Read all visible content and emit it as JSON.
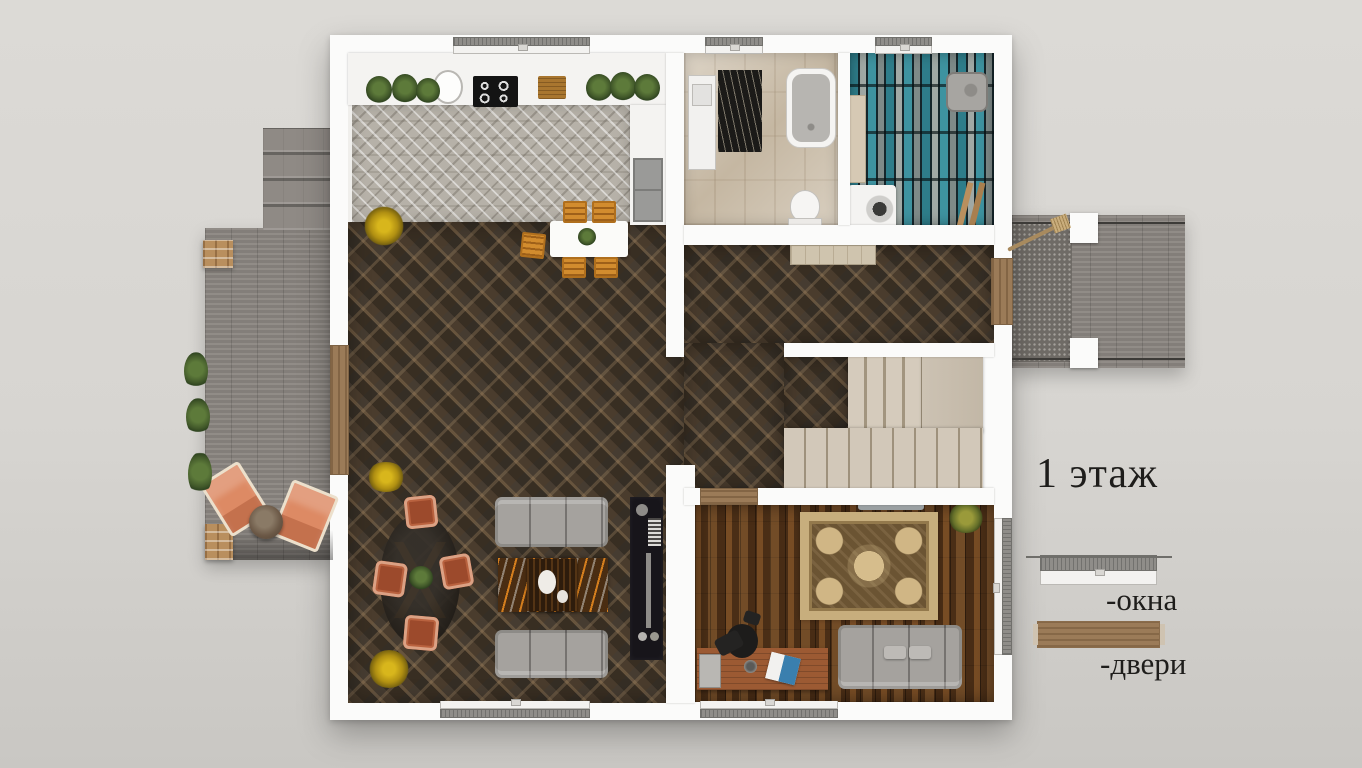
{
  "title": "1 этаж",
  "legend": {
    "items": [
      {
        "symbol": "window",
        "label": "-окна"
      },
      {
        "symbol": "door",
        "label": "-двери"
      }
    ]
  },
  "palette": {
    "background": "#d7d5d1",
    "wall_white": "#fbfbfa",
    "dark_diamond_tile": "#463c31",
    "tile_accent_tan": "#ab8a62",
    "kitchen_herringbone": "#b6b1a8",
    "bathroom_marble": "#cfc3b0",
    "laundry_teal_tile": "#2e7d8a",
    "office_wood": "#5d3a1c",
    "stairs_beige": "#cbc1b2",
    "deck_gray": "#8b8681",
    "door_wood": "#9b7b58",
    "window_gray": "#8f8d89",
    "sofa_gray": "#a5a29e",
    "chair_salmon": "#d9906f",
    "chair_amber": "#d28c2e",
    "rug_beige": "#c7ae7d",
    "text": "#1e1d1b"
  }
}
